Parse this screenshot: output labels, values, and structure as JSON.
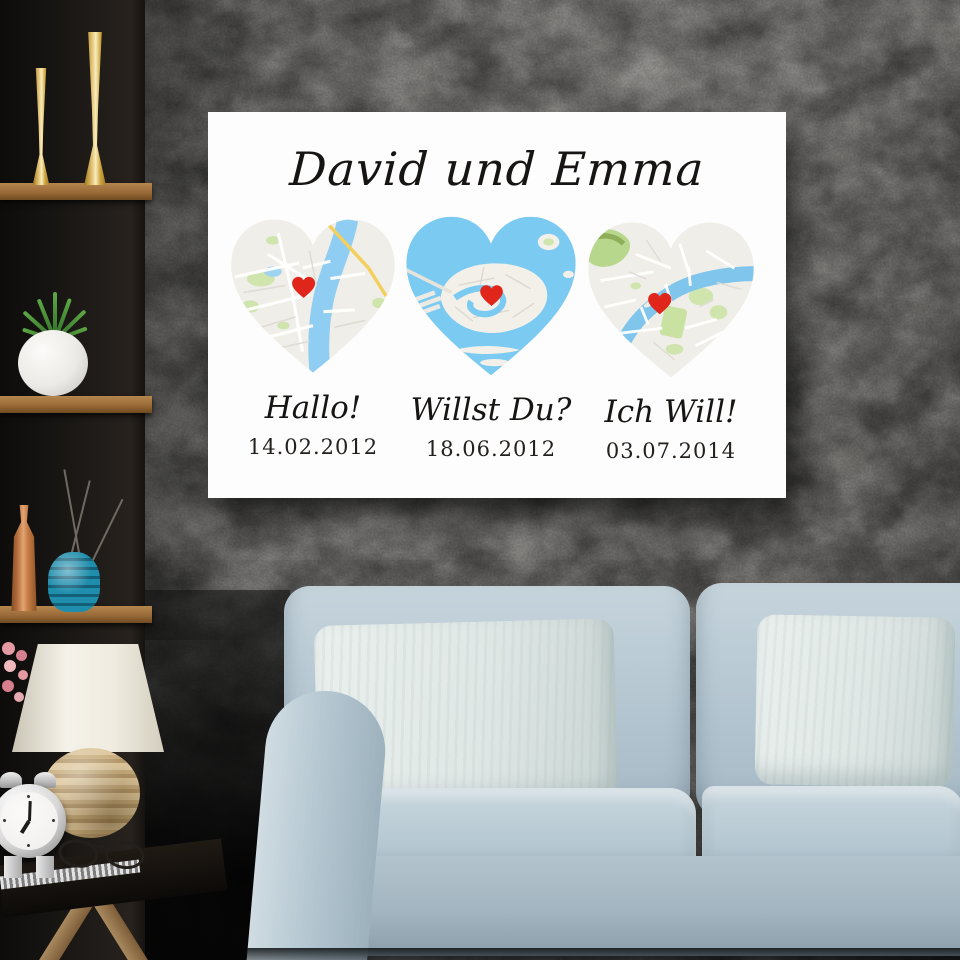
{
  "artwork": {
    "title": "David und Emma",
    "panels": [
      {
        "caption": "Hallo!",
        "date": "14.02.2012",
        "map": "river-city-map-with-heart-marker"
      },
      {
        "caption": "Willst Du?",
        "date": "18.06.2012",
        "map": "lagoon-city-map-with-heart-marker"
      },
      {
        "caption": "Ich Will!",
        "date": "03.07.2014",
        "map": "seine-city-map-with-heart-marker"
      }
    ]
  },
  "scene": {
    "objects": [
      "shelf-unit",
      "gold-vases",
      "potted-plant",
      "copper-vase",
      "teal-vase",
      "dry-branches",
      "table-lamp",
      "flowers",
      "alarm-clock",
      "eyeglasses",
      "side-table",
      "couch",
      "pillows",
      "canvas-print",
      "concrete-wall"
    ]
  },
  "colors": {
    "wall": "#85847f",
    "canvas_bg": "#fdfdfd",
    "text": "#171513",
    "map_land": "#f0eee9",
    "map_water": "#7bcaf1",
    "map_park": "#cfe5ad",
    "map_road_yellow": "#f3cf5e",
    "marker_red": "#e0251b",
    "couch": "#b6c8d2",
    "pillow": "#e3eae8",
    "shelf_wood": "#9a6b38",
    "gold": "#d9b456",
    "copper": "#b06a38",
    "teal": "#1b84a4",
    "lamp_shade": "#f0ece1"
  }
}
